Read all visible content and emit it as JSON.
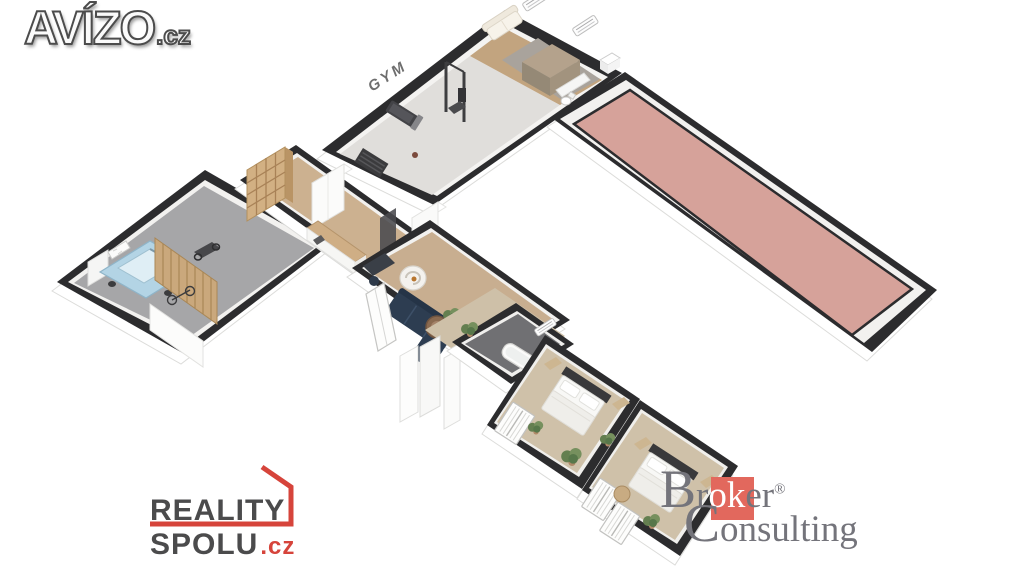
{
  "avizo_logo": {
    "brand": "AVÍZO",
    "tld": ".cz"
  },
  "floorplan": {
    "gym_label": "GYM"
  },
  "reality_spolu_logo": {
    "line1": "REALITY",
    "line2": "SPOLU",
    "tld": ".cz"
  },
  "broker_logo": {
    "cap_b": "B",
    "seg_r": "r",
    "seg_ok": "ok",
    "seg_er": "er",
    "registered": "®",
    "cap_c": "C",
    "rest": "onsulting"
  },
  "colors": {
    "wall_dark": "#2c2c2e",
    "terrace_pink": "#d6a29a",
    "sofa_navy": "#2d3d51",
    "logo_red": "#d6443b",
    "broker_red": "#e2685d",
    "broker_gray": "#74747b",
    "logo_gray": "#4b4b4c",
    "gym_floor": "#e0dedb",
    "wood_floor": "#ccb190",
    "bedroom_floor": "#cfc1a9",
    "garage_floor": "#a6a6a8",
    "bath_floor": "#707073"
  }
}
